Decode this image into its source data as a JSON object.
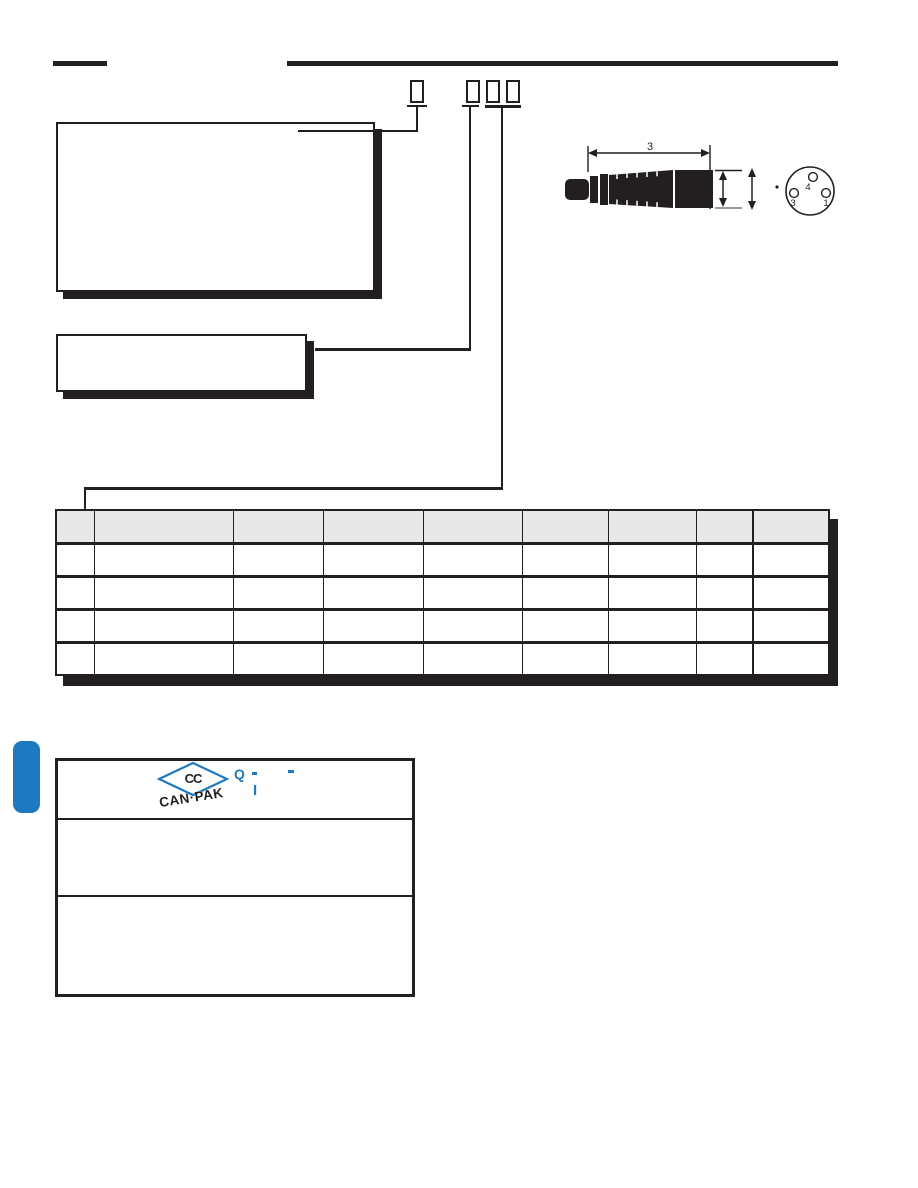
{
  "colors": {
    "ink": "#231f20",
    "accent": "#1d79c0",
    "table_header_fill": "#e8e8e8",
    "dim_cap_gray": "#9b9b9b"
  },
  "order_code": {
    "digit_boxes": [
      "",
      "",
      "",
      ""
    ]
  },
  "diagram": {
    "length_dim_label": "3",
    "face_pins": [
      {
        "label": "4"
      },
      {
        "label": "3"
      },
      {
        "label": "1"
      }
    ]
  },
  "table": {
    "columns": [
      "",
      "",
      "",
      "",
      "",
      "",
      "",
      "",
      ""
    ],
    "rows": [
      [
        "",
        "",
        "",
        "",
        "",
        "",
        "",
        "",
        ""
      ],
      [
        "",
        "",
        "",
        "",
        "",
        "",
        "",
        "",
        ""
      ],
      [
        "",
        "",
        "",
        "",
        "",
        "",
        "",
        "",
        ""
      ],
      [
        "",
        "",
        "",
        "",
        "",
        "",
        "",
        "",
        ""
      ]
    ]
  },
  "footer_box": {
    "logo_monogram": "CC",
    "logo_text": "CAN·PAK",
    "tagline_q": "Q",
    "tagline_i": "I"
  }
}
